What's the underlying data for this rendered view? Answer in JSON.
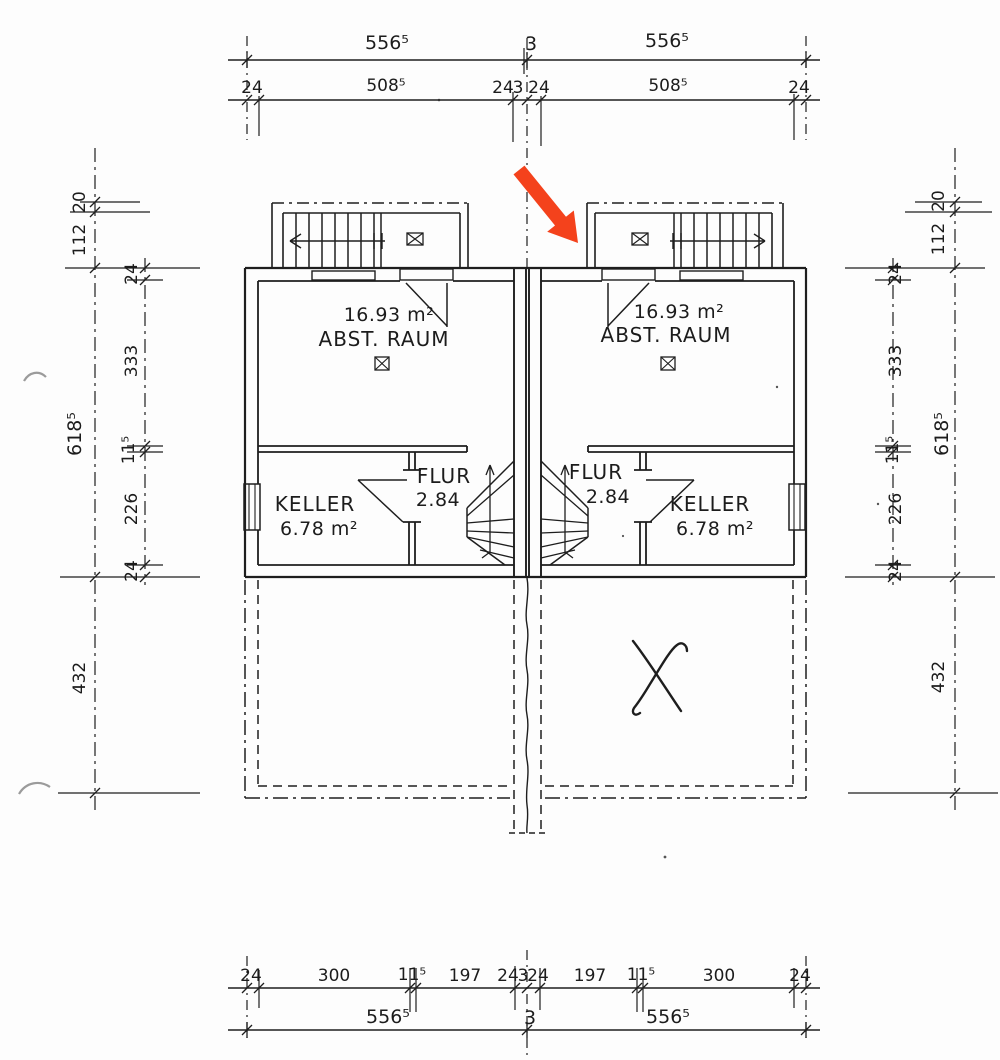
{
  "drawing": {
    "kind": "basement floor plan (Kellergeschoss), mirrored duplex units",
    "annotation": {
      "name": "red marker arrow",
      "color": "#f4421c"
    }
  },
  "rooms": {
    "left_unit": {
      "storage_area": "16.93 m²",
      "storage_name": "ABST. RAUM",
      "cellar_name": "KELLER",
      "cellar_area": "6.78 m²",
      "hall_name": "FLUR",
      "hall_area": "2.84"
    },
    "right_unit": {
      "storage_area": "16.93 m²",
      "storage_name": "ABST. RAUM",
      "cellar_name": "KELLER",
      "cellar_area": "6.78 m²",
      "hall_name": "FLUR",
      "hall_area": "2.84"
    }
  },
  "dimensions": {
    "top_overall": [
      "556⁵",
      "3",
      "556⁵"
    ],
    "top_detail": [
      "24",
      "508⁵",
      "24",
      "3",
      "24",
      "508⁵",
      "24"
    ],
    "bottom_detail": [
      "24",
      "300",
      "11⁵",
      "197",
      "24",
      "3",
      "24",
      "197",
      "11⁵",
      "300",
      "24"
    ],
    "bottom_overall": [
      "556⁵",
      "3",
      "556⁵"
    ],
    "left_outer": [
      "20",
      "112",
      "618⁵",
      "432"
    ],
    "left_inner": [
      "24",
      "333",
      "11⁵",
      "226",
      "24"
    ],
    "right_inner": [
      "24",
      "333",
      "11⁵",
      "226",
      "24"
    ],
    "right_outer": [
      "20",
      "112",
      "618⁵",
      "432"
    ]
  }
}
